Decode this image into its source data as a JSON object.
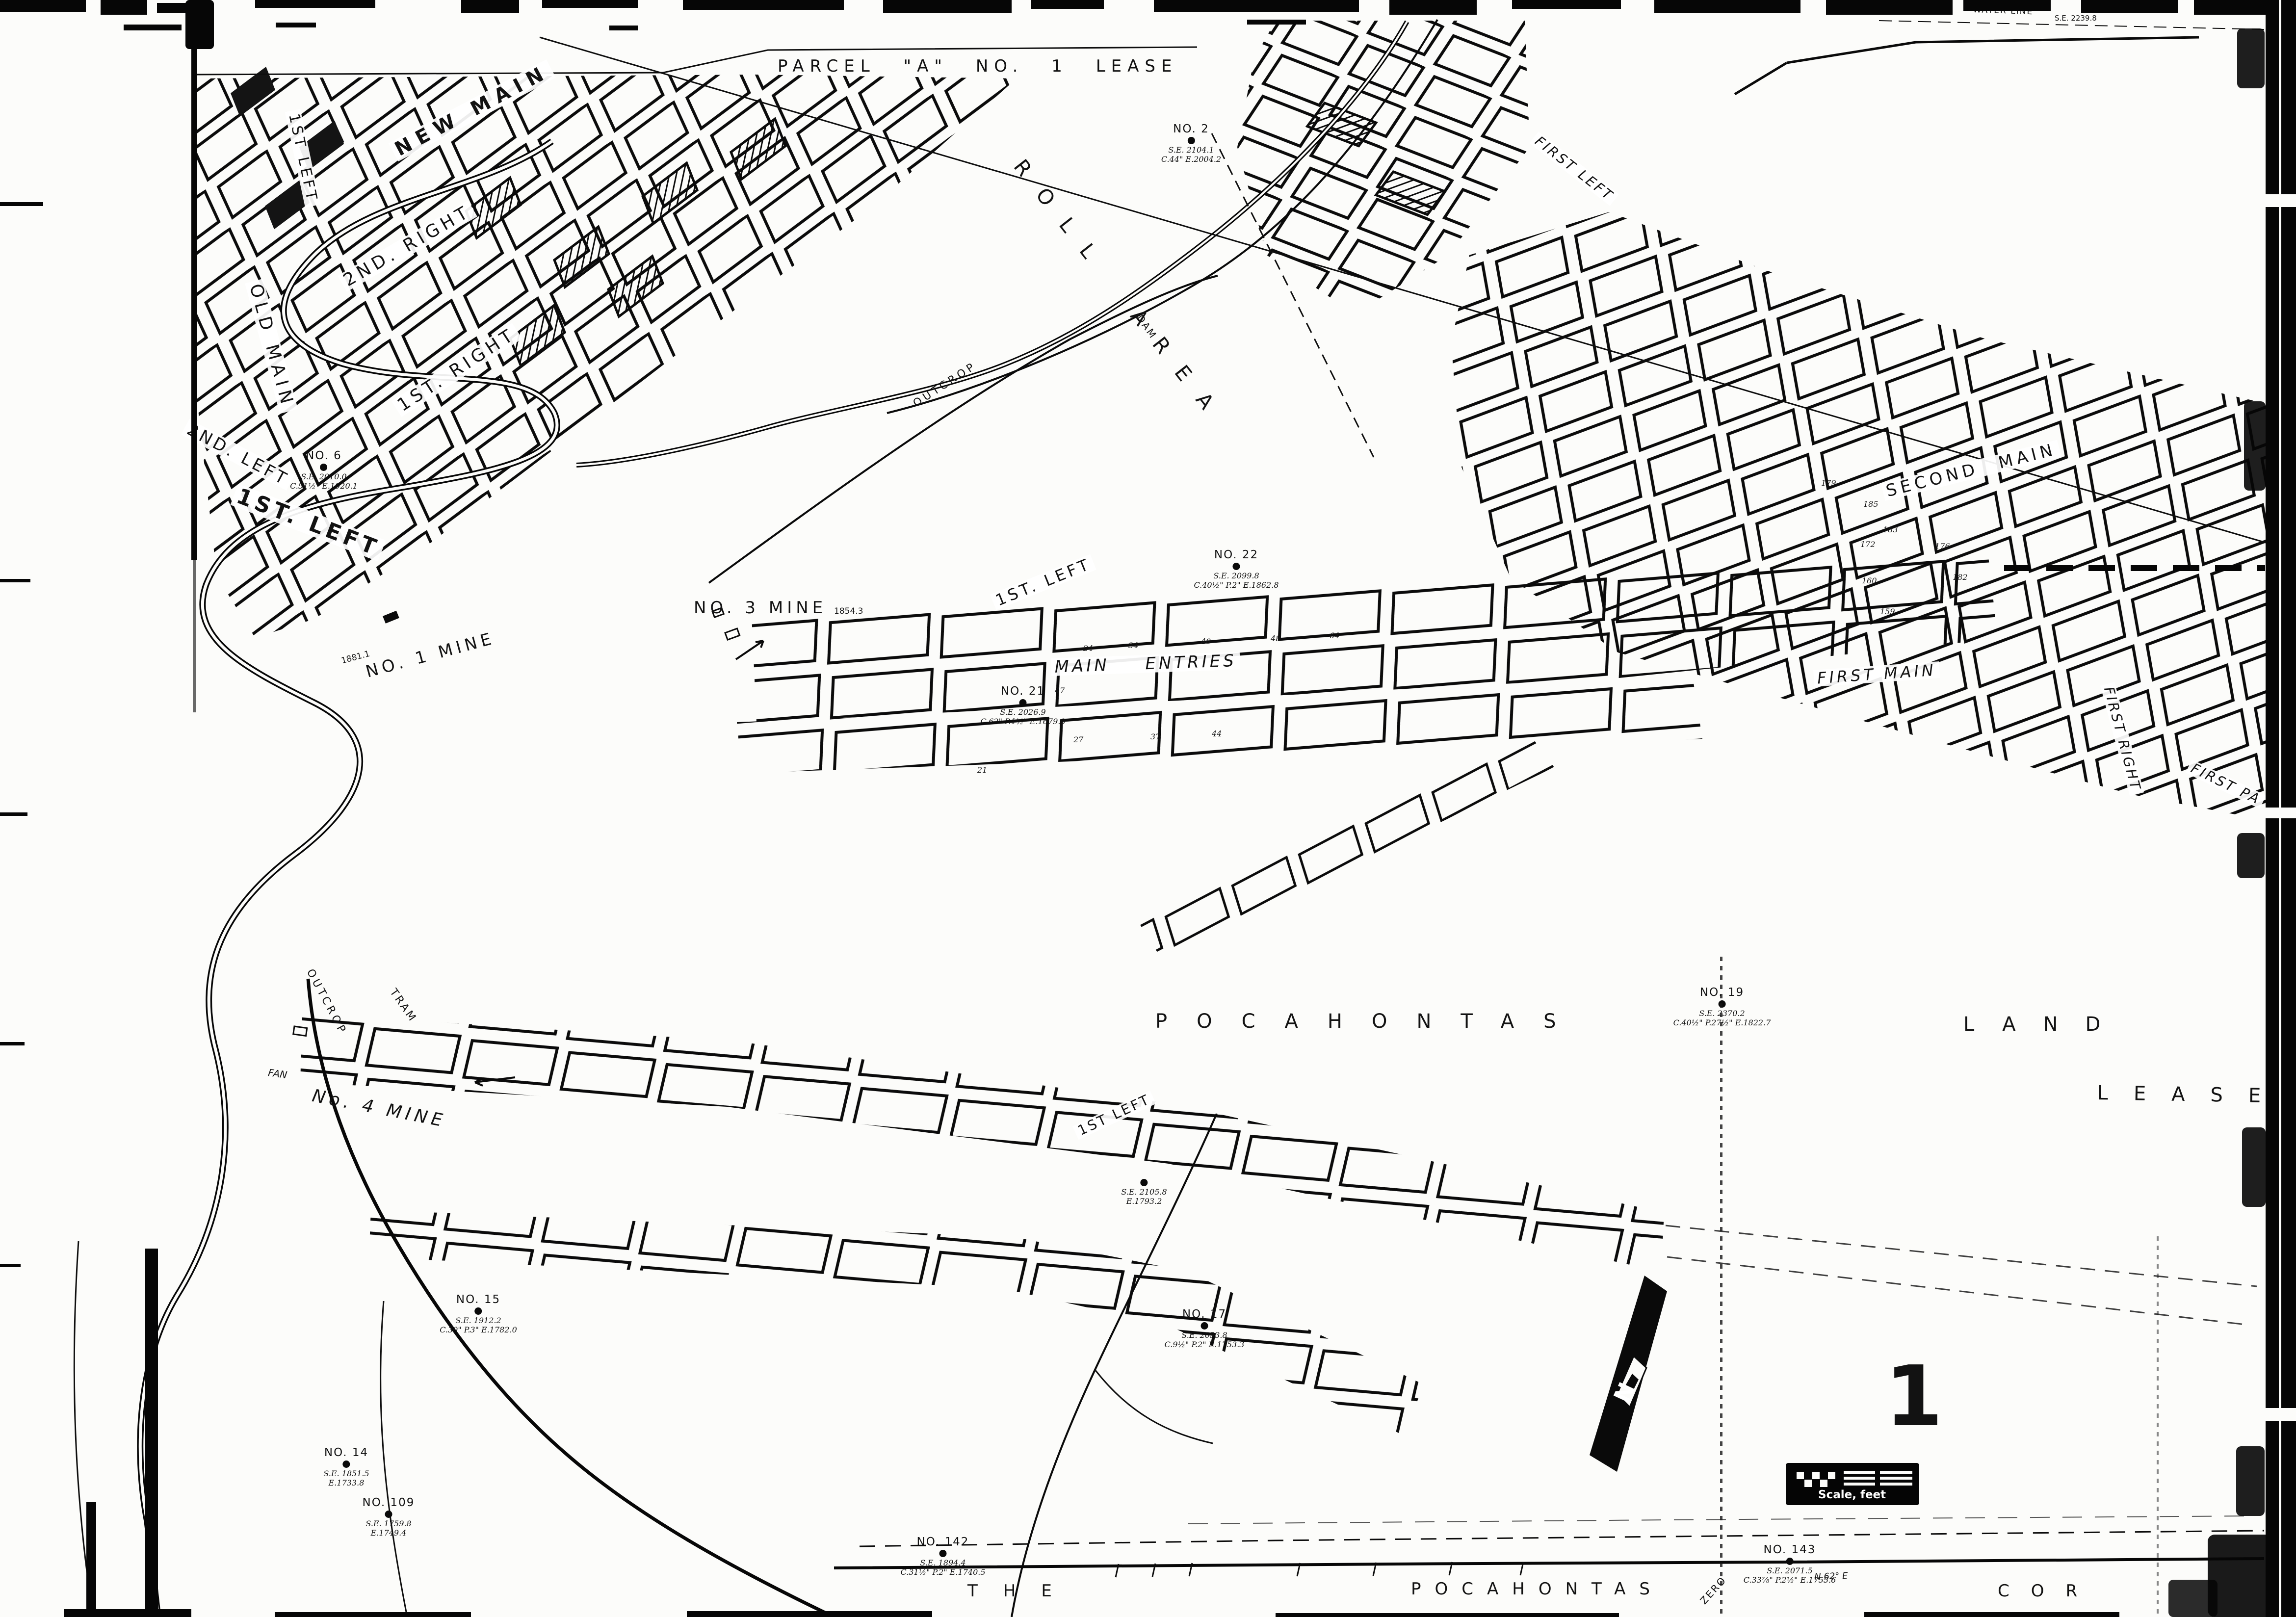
{
  "sheet": {
    "number": "1"
  },
  "titles": {
    "parcel": "PARCEL \"A\"  NO. 1  LEASE",
    "roll_area": "ROLL AREA",
    "water_line": "WATER LINE",
    "se_top_right": "S.E. 2239.8",
    "pocahontas": "POCAHONTAS",
    "land": "LAND",
    "lease": "LEASE",
    "bottom_the": "THE",
    "bottom_pocahontas": "POCAHONTAS",
    "bottom_cor": "COR",
    "bearing": "N 62° E",
    "zero": "ZERO"
  },
  "mines": {
    "no1": {
      "label": "NO. 1 MINE",
      "elevation": "1881.1"
    },
    "no3": {
      "label": "NO. 3 MINE",
      "elevation": "1854.3"
    },
    "no4": {
      "label": "No. 4 MINE",
      "fan": "FAN"
    }
  },
  "headings": {
    "new_main": "NEW MAIN",
    "old_main": "OLD MAIN",
    "first_left_vertical": "1ST LEFT",
    "second_right": "2ND. RIGHT",
    "first_right": "1ST. RIGHT",
    "second_left": "2ND. LEFT",
    "first_left_big": "1ST. LEFT",
    "first_left_entries": "1ST. LEFT",
    "main_entries": "MAIN ENTRIES",
    "first_main": "FIRST MAIN",
    "second_main": "SECOND MAIN",
    "first_left_right_area": "FIRST LEFT",
    "first_right_right_area": "FIRST RIGHT",
    "first_panel": "FIRST PA",
    "first_left_no4": "1ST LEFT",
    "outcrop_no4": "OUTCROP",
    "outcrop_north": "OUTCROP",
    "tram": "TRAM",
    "dam": "DAM"
  },
  "boreholes": [
    {
      "name": "NO. 2",
      "l1": "S.E. 2104.1",
      "l2": "C.44\" E.2004.2"
    },
    {
      "name": "NO. 22",
      "l1": "S.E. 2099.8",
      "l2": "C.40½\" P.2\" E.1862.8"
    },
    {
      "name": "NO. 21",
      "l1": "S.E. 2026.9",
      "l2": "C.62\" P.1½\" E.1679.8"
    },
    {
      "name": "NO. 6",
      "l1": "S.E. 2010.0",
      "l2": "C.51½\" E.1920.1"
    },
    {
      "name": "NO. 19",
      "l1": "S.E. 2370.2",
      "l2": "C.40½\" P.27½\" E.1822.7"
    },
    {
      "name": "NO. 15",
      "l1": "S.E. 1912.2",
      "l2": "C.30\" P.3\" E.1782.0"
    },
    {
      "name": "NO. 17",
      "l1": "S.E. 2053.8",
      "l2": "C.9½\" P.2\" E.1753.3"
    },
    {
      "name": "NO. 142",
      "l1": "S.E. 1894.4",
      "l2": "C.31½\" P.2\" E.1740.5"
    },
    {
      "name": "NO. 143",
      "l1": "S.E. 2071.5",
      "l2": "C.33⅞\" P.2½\" E.1755.6"
    },
    {
      "name": "NO. 14",
      "l1": "S.E. 1851.5",
      "l2": "E.1733.8"
    },
    {
      "name": "NO. 109",
      "l1": "S.E. 1759.8",
      "l2": "E.1749.4"
    },
    {
      "name": "",
      "l1": "S.E. 2105.8",
      "l2": "E.1793.2"
    }
  ],
  "pillar_numbers": [
    "47",
    "24",
    "34",
    "40",
    "48",
    "64",
    "27",
    "44",
    "37",
    "21",
    "179",
    "185",
    "183",
    "172",
    "176",
    "160",
    "159",
    "182"
  ],
  "scale": {
    "label": "Scale, feet"
  },
  "compass": {
    "n": "N"
  }
}
